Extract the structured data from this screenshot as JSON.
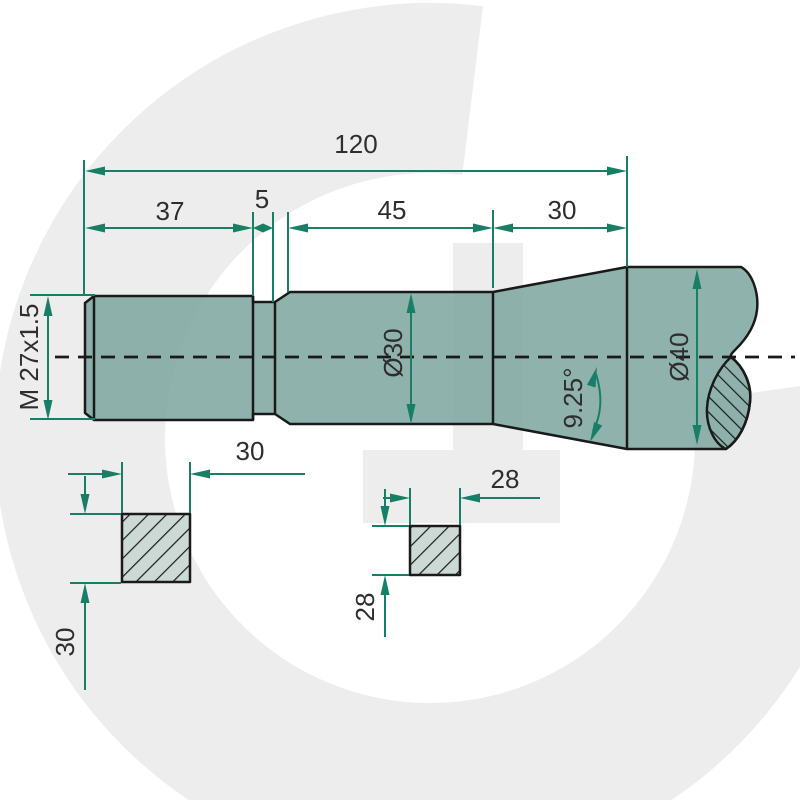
{
  "drawing": {
    "title": "Threaded shaft technical drawing",
    "dimensions": {
      "total_length": "120",
      "thread_length": "37",
      "groove_width": "5",
      "mid_length": "45",
      "end_length": "30",
      "thread_spec": "M 27x1.5",
      "mid_diameter": "Ø30",
      "end_diameter": "Ø40",
      "taper_angle": "9.25°",
      "square1_width": "30",
      "square1_height": "30",
      "square2_width": "28",
      "square2_height": "28"
    },
    "colors": {
      "dimension_green": "#187f66",
      "shaft_fill": "#7ba69d",
      "section_fill": "#ccd9d5",
      "outline": "#1a1a1a",
      "text": "#2e2e2e",
      "watermark": "#ededed",
      "background": "#ffffff"
    }
  }
}
